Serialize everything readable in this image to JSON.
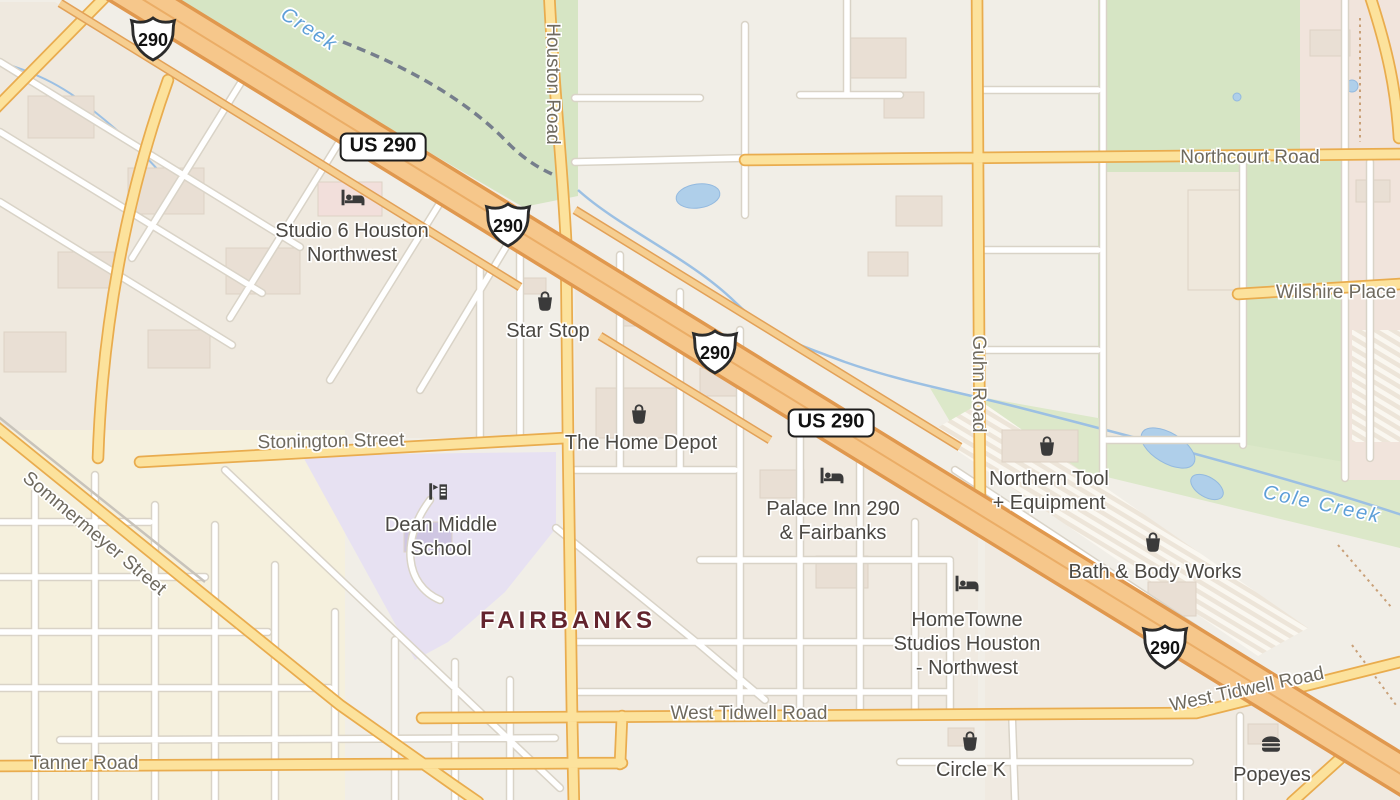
{
  "map_name": "street-map-houston-nw-us290-fairbanks",
  "colors": {
    "land": "#F1EEE7",
    "park_green": "#D6E5C4",
    "school_area_purple": "#E7E1F2",
    "water_blue": "#AFCFEA",
    "highway_fill": "#F6C78B",
    "highway_casing": "#E0984E",
    "arterial_fill": "#FCE29C",
    "arterial_casing": "#E9AC4E",
    "minor_road": "#FFFFFF",
    "poi_text": "#4B4843",
    "road_text": "#6F6A5F",
    "water_text": "#5E9FD8",
    "district_text": "#63242E"
  },
  "pois": [
    {
      "id": "studio-6-houston-northwest",
      "label": "Studio 6 Houston\nNorthwest",
      "icon": "bed-icon",
      "icon_x": 353,
      "icon_y": 198,
      "x": 352,
      "y": 243
    },
    {
      "id": "star-stop",
      "label": "Star Stop",
      "icon": "shopping-bag-icon",
      "icon_x": 545,
      "icon_y": 301,
      "x": 548,
      "y": 331
    },
    {
      "id": "the-home-depot",
      "label": "The Home Depot",
      "icon": "shopping-bag-icon",
      "icon_x": 639,
      "icon_y": 414,
      "x": 641,
      "y": 443
    },
    {
      "id": "palace-inn-290-fairbanks",
      "label": "Palace Inn 290\n& Fairbanks",
      "icon": "bed-icon",
      "icon_x": 832,
      "icon_y": 476,
      "x": 833,
      "y": 521
    },
    {
      "id": "northern-tool-equipment",
      "label": "Northern Tool\n+ Equipment",
      "icon": "shopping-bag-icon",
      "icon_x": 1047,
      "icon_y": 446,
      "x": 1049,
      "y": 491
    },
    {
      "id": "bath-and-body-works",
      "label": "Bath & Body Works",
      "icon": "shopping-bag-icon",
      "icon_x": 1153,
      "icon_y": 542,
      "x": 1155,
      "y": 572
    },
    {
      "id": "hometowne-studios-houston-northwest",
      "label": "HomeTowne\nStudios Houston\n- Northwest",
      "icon": "bed-icon",
      "icon_x": 967,
      "icon_y": 584,
      "x": 967,
      "y": 644
    },
    {
      "id": "circle-k",
      "label": "Circle K",
      "icon": "shopping-bag-icon",
      "icon_x": 970,
      "icon_y": 741,
      "x": 971,
      "y": 770
    },
    {
      "id": "popeyes",
      "label": "Popeyes",
      "icon": "burger-icon",
      "icon_x": 1271,
      "icon_y": 744,
      "x": 1272,
      "y": 775
    },
    {
      "id": "dean-middle-school",
      "label": "Dean Middle\nSchool",
      "icon": "school-icon",
      "icon_x": 438,
      "icon_y": 492,
      "x": 441,
      "y": 537
    }
  ],
  "road_labels": [
    {
      "text": "Houston Road",
      "x": 552,
      "y": 84,
      "rot": 90
    },
    {
      "text": "Guhn Road",
      "x": 978,
      "y": 384,
      "rot": 90
    },
    {
      "text": "Northcourt Road",
      "x": 1250,
      "y": 158,
      "rot": 0
    },
    {
      "text": "Wilshire Place",
      "x": 1336,
      "y": 293,
      "rot": 0
    },
    {
      "text": "Stonington Street",
      "x": 331,
      "y": 442,
      "rot": -1
    },
    {
      "text": "Sommermeyer Street",
      "x": 94,
      "y": 534,
      "rot": 40
    },
    {
      "text": "West Tidwell Road",
      "x": 749,
      "y": 714,
      "rot": 0
    },
    {
      "text": "West Tidwell Road",
      "x": 1247,
      "y": 690,
      "rot": -12
    },
    {
      "text": "Tanner Road",
      "x": 84,
      "y": 764,
      "rot": 0
    }
  ],
  "water_labels": [
    {
      "text": "Creek",
      "x": 309,
      "y": 30,
      "rot": 33
    },
    {
      "text": "Cole Creek",
      "x": 1322,
      "y": 505,
      "rot": 12
    }
  ],
  "area_labels": [
    {
      "text": "FAIRBANKS",
      "x": 568,
      "y": 621
    }
  ],
  "shields": [
    {
      "text": "290",
      "x": 153,
      "y": 39
    },
    {
      "text": "290",
      "x": 508,
      "y": 225
    },
    {
      "text": "290",
      "x": 715,
      "y": 352
    },
    {
      "text": "290",
      "x": 1165,
      "y": 647
    }
  ],
  "route_boxes": [
    {
      "text": "US 290",
      "x": 383,
      "y": 147
    },
    {
      "text": "US 290",
      "x": 831,
      "y": 423
    }
  ]
}
